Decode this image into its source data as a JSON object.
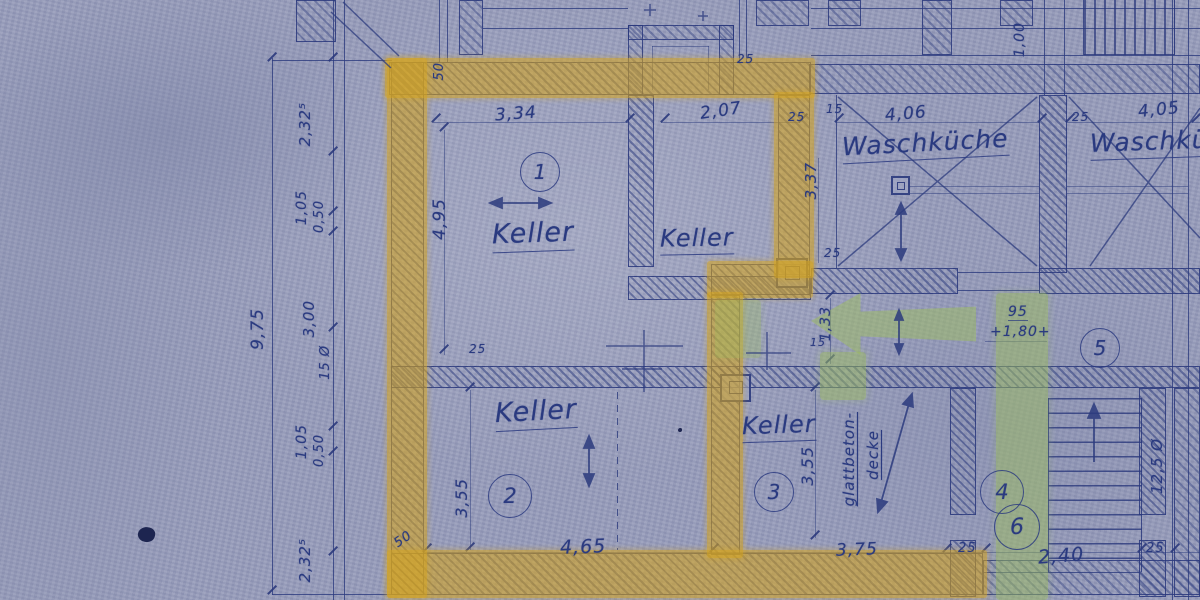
{
  "rooms": {
    "keller1": {
      "name": "Keller",
      "number": "1"
    },
    "keller_mid": {
      "name": "Keller"
    },
    "keller2": {
      "name": "Keller",
      "number": "2"
    },
    "keller3": {
      "name": "Keller",
      "number": "3"
    },
    "waschkueche1": {
      "name": "Waschküche"
    },
    "waschkueche2": {
      "name": "Waschküche"
    },
    "stair_area": {
      "number4": "4",
      "number5": "5",
      "number6": "6"
    }
  },
  "notes": {
    "ceiling_line1": "glattbeton-",
    "ceiling_line2": "decke",
    "stair_note": "12,5 Ø"
  },
  "dims": {
    "k1_w": "3,34",
    "k1_h": "4,95",
    "kmid_w": "2,07",
    "wk1_w": "4,06",
    "wk1_h": "3,37",
    "wk2_w": "4,05",
    "k2_w": "4,65",
    "k2_h": "3,55",
    "k3_w": "3,75",
    "k3_h": "3,55",
    "stair_w": "2,40",
    "corridor_h": "1,33",
    "door_w": "95",
    "door_span": "+1,80+",
    "top_right_v": "1,00",
    "wall50_top": "50",
    "wall50_bottom": "50",
    "tick25": "25",
    "tick15": "15",
    "chain_total": "9,75",
    "chain": [
      "2,32⁵",
      "1,05",
      "0,50",
      "3,00",
      "15 Ø",
      "1,05",
      "0,50",
      "2,32⁵"
    ]
  }
}
